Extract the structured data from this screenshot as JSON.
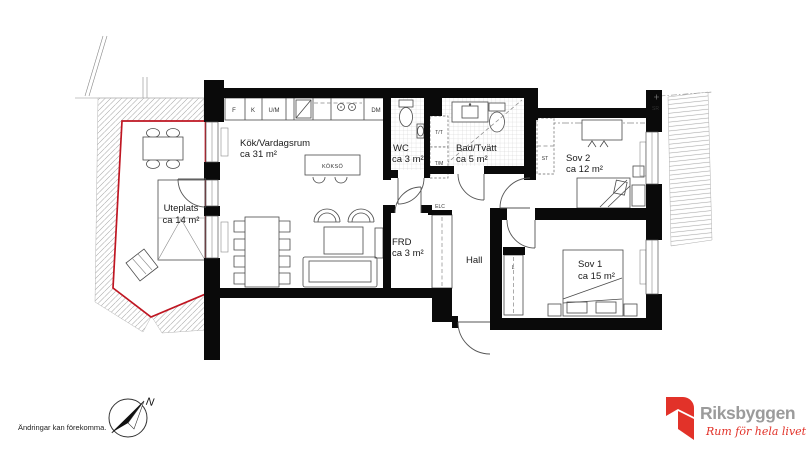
{
  "plan": {
    "rooms": {
      "kitchen_living": {
        "name": "Kök/Vardagsrum",
        "area": "ca 31 m²"
      },
      "island_label": "KÖKSÖ",
      "patio": {
        "name": "Uteplats",
        "area": "ca 14 m²"
      },
      "wc": {
        "name": "WC",
        "area": "ca 3 m²"
      },
      "bath": {
        "name": "Bad/Tvätt",
        "area": "ca 5 m²"
      },
      "bedroom2": {
        "name": "Sov 2",
        "area": "ca 12 m²"
      },
      "bedroom1": {
        "name": "Sov 1",
        "area": "ca 15 m²"
      },
      "storage": {
        "name": "FRD",
        "area": "ca 3 m²"
      },
      "hall": {
        "name": "Hall"
      }
    },
    "markers": {
      "fridge": "F",
      "freezer": "K",
      "oven_micro": "U/M",
      "dishwasher": "DM",
      "dryer": "T/T",
      "washer": "T/M",
      "wardrobe": "ST",
      "linen_closet": "L",
      "electrical": "ELC",
      "shaft": "SR"
    },
    "compass_north": "N"
  },
  "footer": {
    "disclaimer": "Ändringar kan förekomma."
  },
  "logo": {
    "brand": "Riksbyggen",
    "tagline": "Rum för hela livet"
  },
  "colors": {
    "patio_outline": "#bf1622",
    "wall": "#0a0a0a",
    "logo_red": "#e23229",
    "logo_gray": "#9b9b9b"
  }
}
